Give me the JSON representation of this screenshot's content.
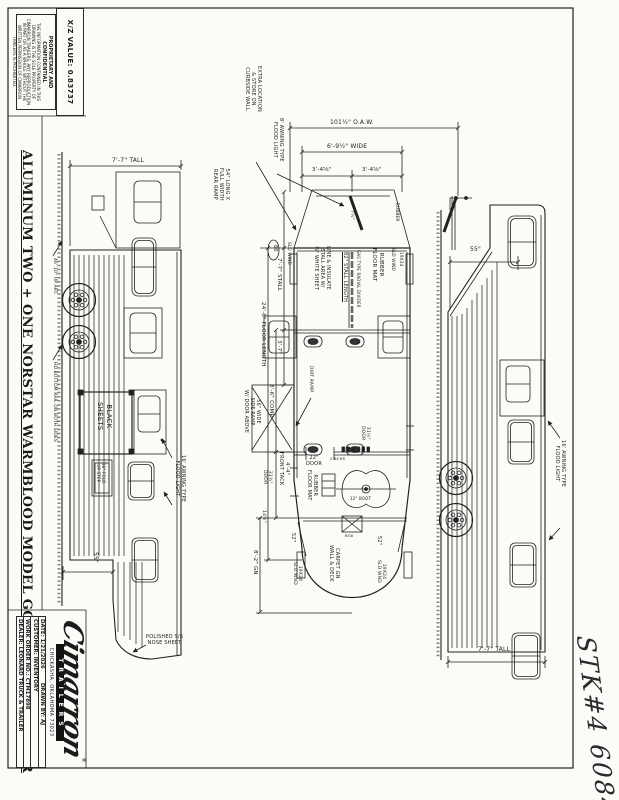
{
  "sheet": {
    "xz_value": "X/Z VALUE:  0.83737",
    "proprietary": {
      "heading": "PROPRIETARY AND CONFIDENTIAL",
      "body": "THE INFORMATION CONTAINED IN THIS DRAWING IS THE SOLE PROPERTY OF CIMARRON TRAILERS.  ANY REPRODUCTION IN PART OR AS A WHOLE WITHOUT THE WRITTEN PERMISSION OF CIMARRON TRAILERS IS PROHIBITED."
    },
    "title": "ALUMINUM TWO + ONE NORSTAR WARMBLOOD MODEL GOOSENECK TRAILER",
    "logo": {
      "brand": "Cimarron",
      "sub": "TRAILERS",
      "reg": "®",
      "address": "CHICKASHA, OKLAHOMA 73023"
    },
    "title_block": {
      "date": "DATE:  1/21/2026",
      "drawn_by": "DRAWN BY:  AJ",
      "customer": "CUSTOMER:  INVENTORY",
      "work_order": "WORK ORDER NO.: CTM17898",
      "dealer": "DEALER:  LEONARD TRUCK & TRAILER"
    },
    "handwritten_note": "STK#4 6084"
  },
  "annotations": [
    {
      "n": "dim-7-7-tall-left",
      "t": "7'-7\" TALL",
      "x": 112,
      "y": 157,
      "r": 0,
      "s": 6
    },
    {
      "n": "label-black-sheets",
      "t": "BLACK\nSHEETS",
      "x": 113,
      "y": 402,
      "r": 90,
      "s": 7
    },
    {
      "n": "label-fold-up-step",
      "t": "36\" FOLD\nUP STEP",
      "x": 105,
      "y": 463,
      "r": 90,
      "s": 4
    },
    {
      "n": "label-awning-16-left",
      "t": "16' AWNING TYPE\nFLOOD LIGHT",
      "x": 186,
      "y": 455,
      "r": 90,
      "s": 5
    },
    {
      "n": "dim-55-left",
      "t": "55\"",
      "x": 99,
      "y": 552,
      "r": 90,
      "s": 6
    },
    {
      "n": "label-polished-nose-sheet",
      "t": "POLISHED S/S\nNOSE SHEET",
      "x": 146,
      "y": 634,
      "r": 0,
      "s": 5
    },
    {
      "n": "label-hd-bottom-rail",
      "t": "HD BOTTOM RAIL ON BOTH SIDES",
      "x": 57,
      "y": 362,
      "r": 90,
      "s": 4.4
    },
    {
      "n": "label-up-art",
      "t": "46' 10\" UP ART.",
      "x": 57,
      "y": 258,
      "r": 90,
      "s": 4.4
    },
    {
      "n": "dim-oaw",
      "t": "101½\" O.A.W.",
      "x": 330,
      "y": 119,
      "r": 0,
      "s": 6
    },
    {
      "n": "dim-wide",
      "t": "6'-9½\" WIDE",
      "x": 327,
      "y": 143,
      "r": 0,
      "s": 6
    },
    {
      "n": "dim-3-4-left",
      "t": "3'-4⅝\"",
      "x": 312,
      "y": 167,
      "r": 0,
      "s": 5.5
    },
    {
      "n": "dim-3-4-right",
      "t": "3'-4⅝\"",
      "x": 362,
      "y": 167,
      "r": 0,
      "s": 5.5
    },
    {
      "n": "label-extra-location",
      "t": "EXTRA LOCATION\n& STORE ON\nCURBSIDE WALL",
      "x": 262,
      "y": 66,
      "r": 90,
      "s": 5
    },
    {
      "n": "label-awning-8",
      "t": "8' AWNING TYPE\nFLOOD LIGHT",
      "x": 284,
      "y": 118,
      "r": 90,
      "s": 5
    },
    {
      "n": "label-rear-ramp",
      "t": "54\" LONG X\nFULL WIDTH\nREAR RAMP",
      "x": 230,
      "y": 168,
      "r": 90,
      "s": 5
    },
    {
      "n": "dim-7-7-stall",
      "t": "7'-7\" STALL",
      "x": 282,
      "y": 258,
      "r": 90,
      "s": 5.5
    },
    {
      "n": "dim-3-7",
      "t": "3'-7\"",
      "x": 282,
      "y": 340,
      "r": 90,
      "s": 5.5
    },
    {
      "n": "dim-8-6-comp",
      "t": "8'-6\" COMP",
      "x": 274,
      "y": 384,
      "r": 90,
      "s": 5.5
    },
    {
      "n": "dim-24-6-floor",
      "t": "24'-6\" FLOOR LENGTH",
      "x": 266,
      "y": 302,
      "r": 90,
      "s": 5.5
    },
    {
      "n": "dim-8-2-gn",
      "t": "8'-2\" GN",
      "x": 258,
      "y": 550,
      "r": 90,
      "s": 5.5
    },
    {
      "n": "dim-4-4-front-tack",
      "t": "4'-4\"\nFRONT TACK",
      "x": 290,
      "y": 452,
      "r": 90,
      "s": 5
    },
    {
      "n": "label-rubber-floor-mat-stall",
      "t": "RUBBER\nFLOOR MAT",
      "x": 384,
      "y": 248,
      "r": 90,
      "s": 5.5
    },
    {
      "n": "dim-82-stall-length",
      "t": "82\" STALL LENGTH",
      "x": 348,
      "y": 252,
      "r": 90,
      "s": 5,
      "u": true
    },
    {
      "n": "label-radial-divider",
      "t": "GAS TYPE RADIAL DIVIDER",
      "x": 360,
      "y": 250,
      "r": 90,
      "s": 4
    },
    {
      "n": "label-line-insulate",
      "t": "LINE & INSULATE\nSTALL AREA W/\n⅜\" WHITE SHEET",
      "x": 330,
      "y": 246,
      "r": 90,
      "s": 4.8
    },
    {
      "n": "balloon-60",
      "t": "60",
      "x": 278,
      "y": 245,
      "r": 90,
      "s": 5
    },
    {
      "n": "label-sld-wind-left",
      "t": "SLD WIND",
      "x": 292,
      "y": 242,
      "r": 90,
      "s": 4.2
    },
    {
      "n": "label-sld-wind-right",
      "t": "SLD WIND",
      "x": 396,
      "y": 248,
      "r": 90,
      "s": 4.2
    },
    {
      "n": "label-19x34-right",
      "t": "19X34",
      "x": 404,
      "y": 252,
      "r": 90,
      "s": 4.2
    },
    {
      "n": "dim-7-half",
      "t": "7½\"",
      "x": 354,
      "y": 210,
      "r": 90,
      "s": 4.5
    },
    {
      "n": "label-rubber-ramp",
      "t": "RUBBER",
      "x": 400,
      "y": 203,
      "r": 90,
      "s": 4.2
    },
    {
      "n": "label-dirt-ramp",
      "t": "DIRT RAMP",
      "x": 313,
      "y": 366,
      "r": 90,
      "s": 4.5
    },
    {
      "n": "label-side-ramp",
      "t": "56\" WIDE\nSIDE RAMP\nW/ DOOR ABOVE",
      "x": 260,
      "y": 390,
      "r": 90,
      "s": 4.8
    },
    {
      "n": "dim-22-door",
      "t": "22\"\nDOOR",
      "x": 306,
      "y": 455,
      "r": 0,
      "s": 5
    },
    {
      "n": "dim-31-34-door",
      "t": "31¾\"\nDOOR",
      "x": 272,
      "y": 470,
      "r": 90,
      "s": 4.5
    },
    {
      "n": "dim-31-14-door",
      "t": "31¼\"\nDOOR",
      "x": 370,
      "y": 426,
      "r": 90,
      "s": 4.5
    },
    {
      "n": "label-rubber-floor-mat-tack",
      "t": "RUBBER\nFLOOR MAT",
      "x": 318,
      "y": 470,
      "r": 90,
      "s": 5
    },
    {
      "n": "label-2-bchs",
      "t": "2 BCHS",
      "x": 330,
      "y": 457,
      "r": 0,
      "s": 3.8
    },
    {
      "n": "label-12-boot",
      "t": "12\" BOOT",
      "x": 350,
      "y": 497,
      "r": 0,
      "s": 4
    },
    {
      "n": "label-box",
      "t": "BOX",
      "x": 345,
      "y": 534,
      "r": 0,
      "s": 3.8
    },
    {
      "n": "dim-14-34",
      "t": "14¾\"",
      "x": 266,
      "y": 510,
      "r": 90,
      "s": 4.5
    },
    {
      "n": "dim-52-left",
      "t": "52\"",
      "x": 296,
      "y": 533,
      "r": 90,
      "s": 5
    },
    {
      "n": "dim-52-right",
      "t": "52\"",
      "x": 382,
      "y": 536,
      "r": 90,
      "s": 5
    },
    {
      "n": "label-19x24-left",
      "t": "19X24\nSLD WND",
      "x": 302,
      "y": 562,
      "r": 90,
      "s": 4.5
    },
    {
      "n": "label-19x24-right",
      "t": "19X24\nSLD WND",
      "x": 386,
      "y": 560,
      "r": 90,
      "s": 4.5
    },
    {
      "n": "label-carpet-gn",
      "t": "CARPET GN\nWALL & DECK",
      "x": 340,
      "y": 545,
      "r": 90,
      "s": 5
    },
    {
      "n": "dim-55-right",
      "t": "55\"",
      "x": 470,
      "y": 246,
      "r": 0,
      "s": 6
    },
    {
      "n": "label-awning-16-right",
      "t": "16' AWNING TYPE\nFLOOD LIGHT",
      "x": 566,
      "y": 440,
      "r": 90,
      "s": 5
    },
    {
      "n": "dim-7-7-tall-right",
      "t": "7'-7\" TALL",
      "x": 478,
      "y": 646,
      "r": 0,
      "s": 6
    }
  ]
}
